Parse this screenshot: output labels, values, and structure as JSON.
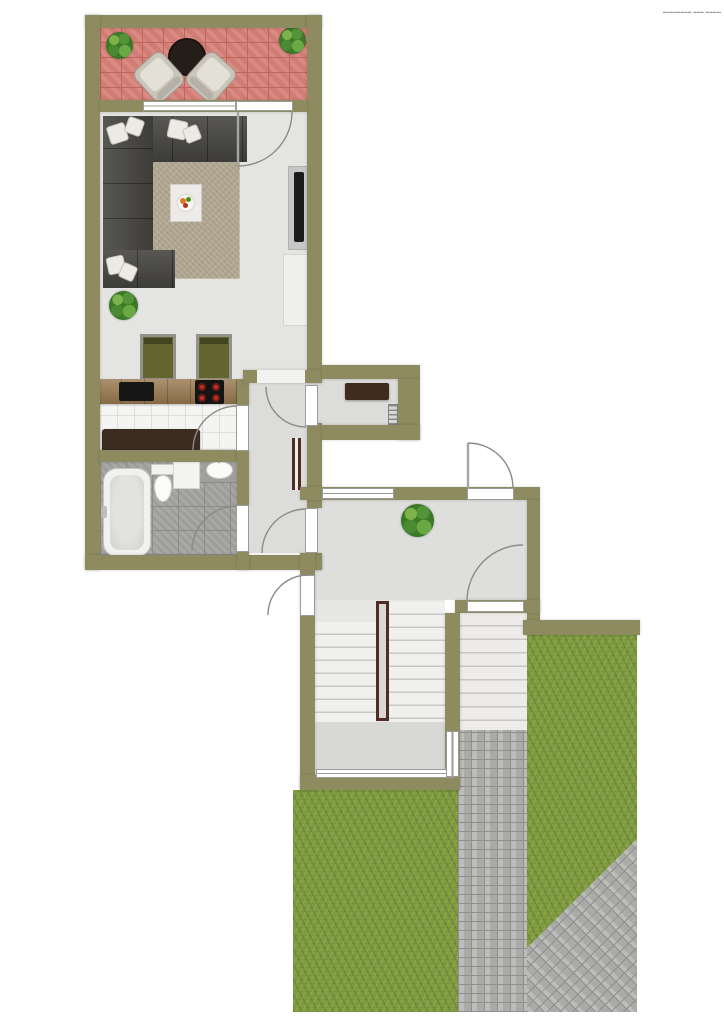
{
  "meta": {
    "title": "apartment-floor-plan",
    "watermark": "▂▂▂▂▂▂▂▂ ▂▂▂ ▂▂▂▂▂▂▂▂"
  },
  "palette": {
    "wall": "#8e8b60",
    "outside": "#ffffff",
    "living_floor": "#e4e4e2",
    "hall_floor": "#dcdcda",
    "landing_floor": "#dededc",
    "stair_floor": "#e7e7e5",
    "lower_landing_floor": "#d8d8d6",
    "kitchen_tile": "#f4f4f2",
    "kitchen_grout": "#dededc",
    "bath_tile": "#a3a3a1",
    "bath_grout": "#8b8b89",
    "balcony_paver": "#d8837a",
    "balcony_grout": "#bf655c",
    "counter_wood": "#997950",
    "wood_dark": "#3b2b21",
    "sofa": "#454440",
    "rug": "#b3a994",
    "chair_seat": "#63652e",
    "plant_dark": "#2d5e1d",
    "table_dark": "#241d18",
    "grass": "#7f9c42",
    "paver": "#b3b3b1",
    "paver_grout": "#8f8f8d",
    "rail": "#4f2d24",
    "step_edge": "#c8c8c6",
    "arc": "#8b8b89",
    "tv": "#1c1c1c",
    "burner": "#c03226"
  },
  "rooms": [
    {
      "name": "balcony"
    },
    {
      "name": "living-room"
    },
    {
      "name": "kitchen"
    },
    {
      "name": "bathroom"
    },
    {
      "name": "hallway"
    },
    {
      "name": "corridor-nook"
    },
    {
      "name": "stair-landing"
    },
    {
      "name": "staircase"
    },
    {
      "name": "exterior-stairs"
    },
    {
      "name": "garden-lawn"
    },
    {
      "name": "paved-path"
    }
  ],
  "furniture": [
    "balcony-plants",
    "balcony-round-table",
    "balcony-armchairs",
    "sectional-sofa",
    "throw-pillows",
    "area-rug",
    "coffee-table",
    "fruit-bowl",
    "tv",
    "tv-console",
    "sideboard-cabinet",
    "floor-plant",
    "dining-chairs",
    "kitchen-counter",
    "kitchen-sink",
    "cooktop",
    "storage-bench",
    "bathtub",
    "toilet",
    "shower-tray",
    "washbasin",
    "hall-radiator",
    "nook-sideboard",
    "nook-radiator",
    "landing-plant",
    "stair-handrail"
  ]
}
